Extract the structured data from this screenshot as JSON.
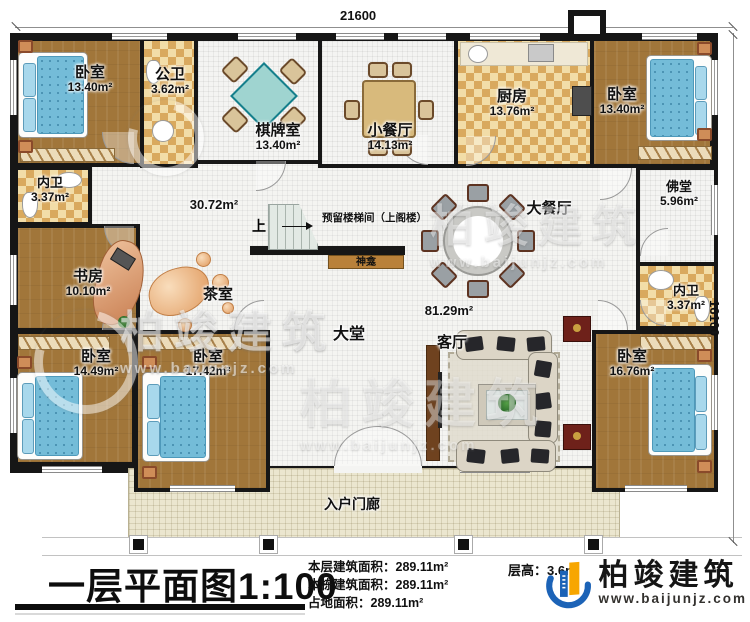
{
  "plan": {
    "dim_top": "21600",
    "dim_right": "16100",
    "stair_up": "上",
    "stair_note": "预留楼梯间（上阁楼）",
    "shrine": "神龛",
    "open_area_1": "30.72m²",
    "open_area_2": "81.29m²"
  },
  "rooms": {
    "bedroom_tl": {
      "name": "卧室",
      "area": "13.40m²"
    },
    "public_bath": {
      "name": "公卫",
      "area": "3.62m²"
    },
    "chess_room": {
      "name": "棋牌室",
      "area": "13.40m²"
    },
    "small_dining": {
      "name": "小餐厅",
      "area": "14.13m²"
    },
    "kitchen": {
      "name": "厨房",
      "area": "13.76m²"
    },
    "bedroom_tr": {
      "name": "卧室",
      "area": "13.40m²"
    },
    "inner_bath_left": {
      "name": "内卫",
      "area": "3.37m²"
    },
    "study": {
      "name": "书房",
      "area": "10.10m²"
    },
    "tea_room": {
      "name": "茶室"
    },
    "big_dining": {
      "name": "大餐厅"
    },
    "buddha_hall": {
      "name": "佛堂",
      "area": "5.96m²"
    },
    "inner_bath_right": {
      "name": "内卫",
      "area": "3.37m²"
    },
    "bedroom_bl": {
      "name": "卧室",
      "area": "14.49m²"
    },
    "bedroom_bm": {
      "name": "卧室",
      "area": "17.42m²"
    },
    "main_hall": {
      "name": "大堂"
    },
    "living_room": {
      "name": "客厅"
    },
    "bedroom_br": {
      "name": "卧室",
      "area": "16.76m²"
    },
    "porch": {
      "name": "入户门廊"
    }
  },
  "footer": {
    "title": "一层平面图1:100",
    "stats": [
      {
        "label": "本层建筑面积：",
        "value": "289.11m²"
      },
      {
        "label": "本栋建筑面积：",
        "value": "289.11m²"
      },
      {
        "label": "占地面积：",
        "value": "289.11m²"
      }
    ],
    "floor_height_label": "层高：",
    "floor_height_value": "3.6m",
    "brand": "柏竣建筑",
    "brand_url": "www.baijunjz.com"
  },
  "watermark": {
    "brand": "柏竣建筑",
    "url": "www.baijunjz.com"
  },
  "colors": {
    "wall": "#161616",
    "wood_floor": "#a1763a",
    "checker_dark": "#d9a95e",
    "checker_light": "#f2dda8",
    "bed_blue": "#74bcd8",
    "logo_blue": "#1c63b7",
    "logo_orange": "#f7a600"
  }
}
